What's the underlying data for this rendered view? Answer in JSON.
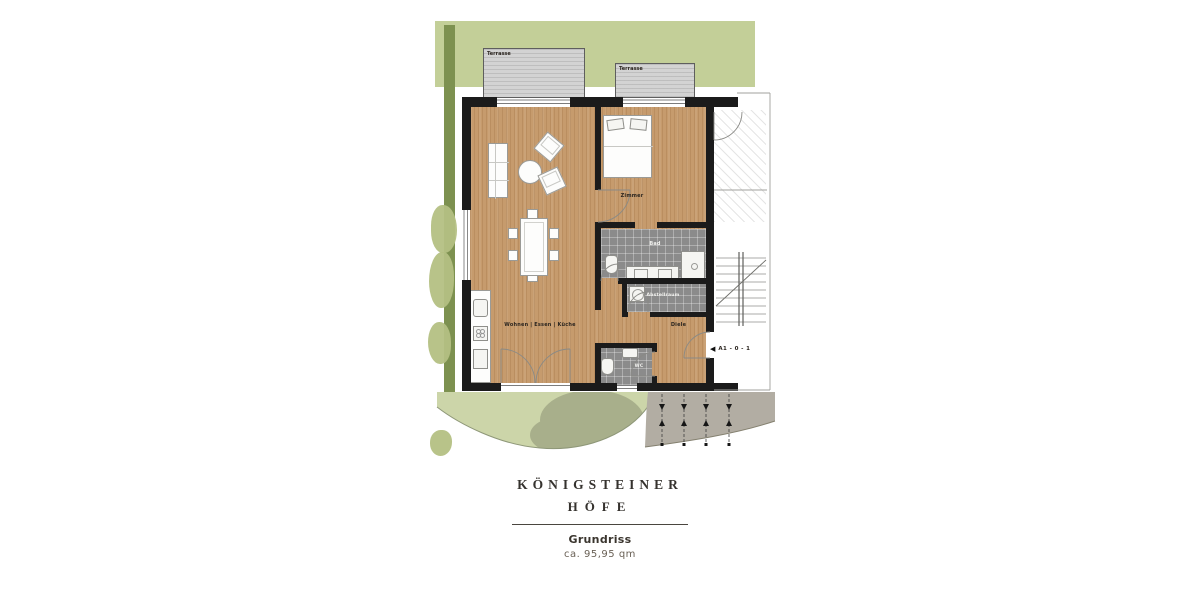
{
  "site": {
    "terrace_left_label": "Terrasse",
    "terrace_right_label": "Terrasse"
  },
  "rooms": {
    "living": "Wohnen | Essen | Küche",
    "bedroom": "Zimmer",
    "bath": "Bad",
    "storage": "Abstellraum",
    "hall": "Diele",
    "wc": "WC"
  },
  "unit": {
    "arrow_icon": "◀",
    "code": "A1 - 0 - 1"
  },
  "branding": {
    "name_line1": "KÖNIGSTEINER",
    "name_line2": "HÖFE"
  },
  "caption": {
    "title": "Grundriss",
    "area": "ca. 95,95 qm"
  },
  "colors": {
    "lawn": "#c3cf98",
    "hedge": "#7d9150",
    "garden": "#ccd5a9",
    "tree": "#a8af8b",
    "path": "#b2ada3",
    "wood_floor": "#c69b6d",
    "tile": "#8b8b8b",
    "terrace": "#d3d3d3",
    "wall": "#1b1b1b",
    "brand_text": "#35322e"
  }
}
